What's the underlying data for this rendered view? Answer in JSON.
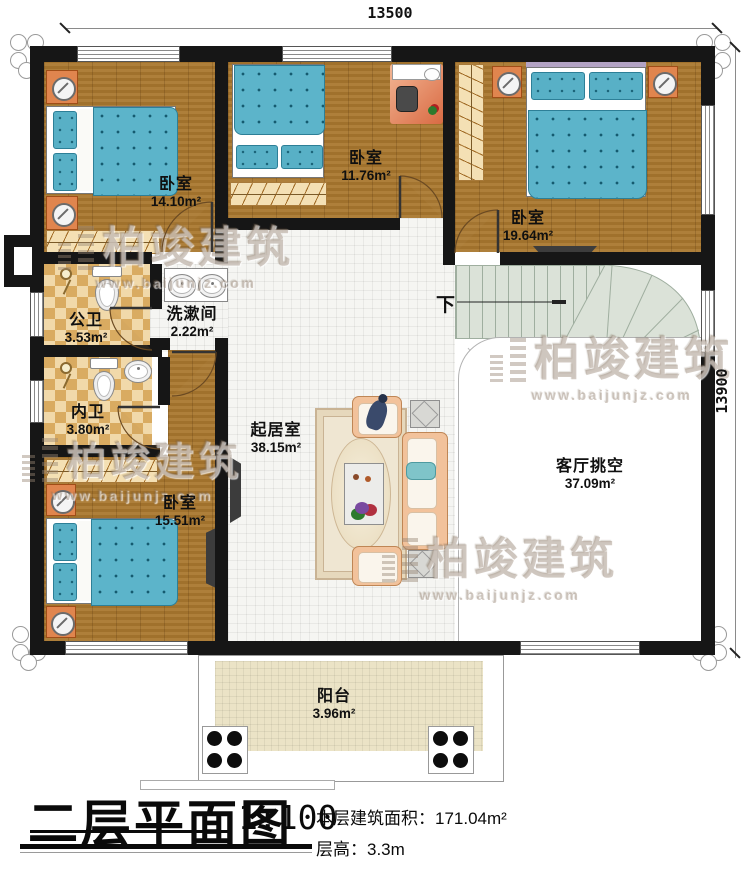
{
  "dimensions": {
    "top": "13500",
    "right": "13900"
  },
  "rooms": [
    {
      "name": "卧室",
      "area": "14.10m²"
    },
    {
      "name": "卧室",
      "area": "11.76m²"
    },
    {
      "name": "卧室",
      "area": "19.64m²"
    },
    {
      "name": "公卫",
      "area": "3.53m²"
    },
    {
      "name": "洗漱间",
      "area": "2.22m²"
    },
    {
      "name": "内卫",
      "area": "3.80m²"
    },
    {
      "name": "卧室",
      "area": "15.51m²"
    },
    {
      "name": "起居室",
      "area": "38.15m²"
    },
    {
      "name": "客厅挑空",
      "area": "37.09m²"
    },
    {
      "name": "阳台",
      "area": "3.96m²"
    }
  ],
  "stair": {
    "down_label": "下"
  },
  "watermark": {
    "brand": "柏竣建筑",
    "url": "www.baijunjz.com"
  },
  "title_block": {
    "title": "二层平面图",
    "scale": "1:100",
    "area_label": "本层建筑面积：",
    "area_value": "171.04m²",
    "height_label": "层高：",
    "height_value": "3.3m"
  }
}
